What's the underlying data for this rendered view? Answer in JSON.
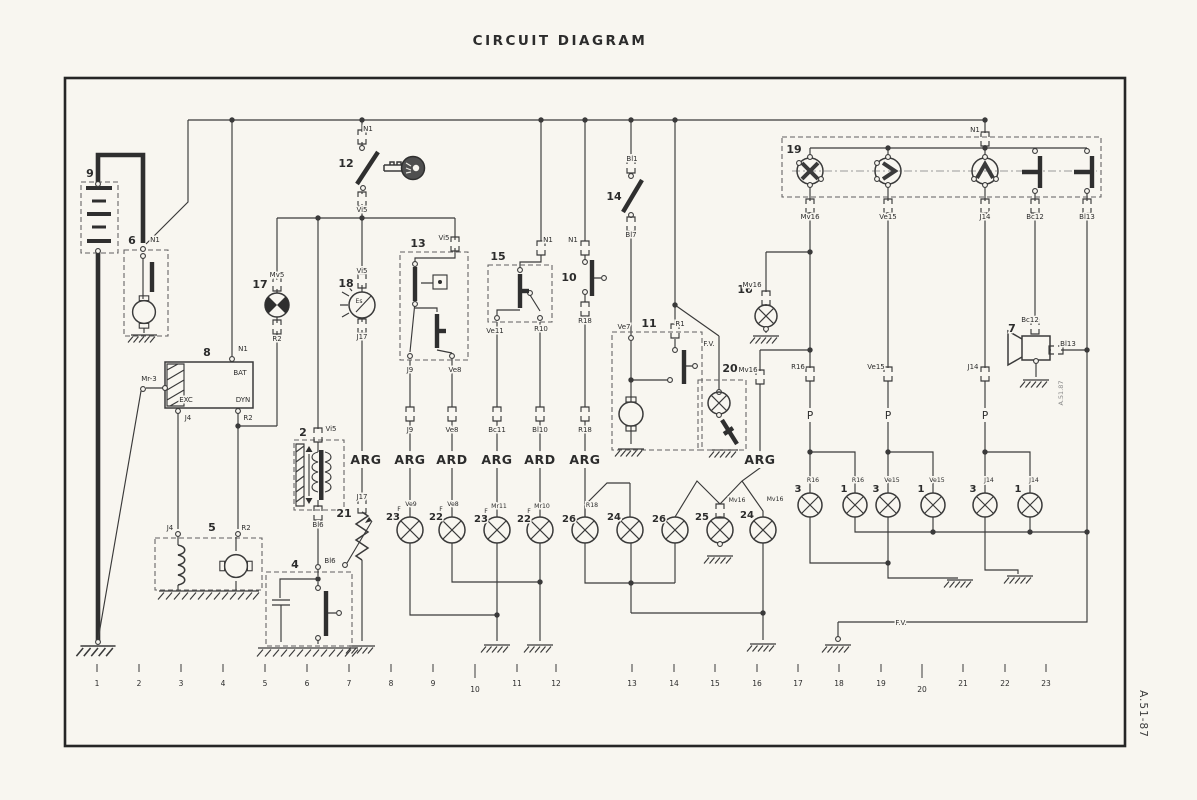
{
  "title": "CIRCUIT DIAGRAM",
  "refs": {
    "outer": "A.51-87",
    "inner": "A.51.87"
  },
  "codes": {
    "N1": "N1",
    "Vi5": "Vi5",
    "Mv5": "Mv5",
    "R2": "R2",
    "J17": "J17",
    "Es": "Es",
    "Bl1": "Bl1",
    "Bl7": "Bl7",
    "Bl6": "Bl6",
    "J4": "J4",
    "Mr3": "Mr-3",
    "BAT": "BAT",
    "EXC": "EXC",
    "DYN": "DYN",
    "J9": "J9",
    "Ve8": "Ve8",
    "F": "F",
    "Ve9": "Ve9",
    "Mr11": "Mr11",
    "Mr10": "Mr10",
    "Bc11": "Bc11",
    "Bl10": "Bl10",
    "Ve11": "Ve11",
    "R10": "R10",
    "R18": "R18",
    "Ve7": "Ve7",
    "R1": "R1",
    "FV": "F.V.",
    "Mv16": "Mv16",
    "Ve15": "Ve15",
    "J14": "J14",
    "Bc12": "Bc12",
    "Bl13": "Bl13",
    "R16": "R16",
    "P": "P",
    "ARG": "ARG",
    "ARD": "ARD"
  },
  "num": {
    "n1": "1",
    "n2": "2",
    "n3": "3",
    "n4": "4",
    "n5": "5",
    "n6": "6",
    "n7": "7",
    "n8": "8",
    "n9": "9",
    "n10": "10",
    "n11": "11",
    "n12": "12",
    "n13": "13",
    "n14": "14",
    "n15": "15",
    "n16": "16",
    "n17": "17",
    "n18": "18",
    "n19": "19",
    "n20": "20",
    "n21": "21",
    "n22": "22",
    "n23": "23",
    "n24": "24",
    "n25": "25",
    "n26": "26"
  },
  "scale": [
    "1",
    "2",
    "3",
    "4",
    "5",
    "6",
    "7",
    "8",
    "9",
    "10",
    "11",
    "12",
    "13",
    "14",
    "15",
    "16",
    "17",
    "18",
    "19",
    "20",
    "21",
    "22",
    "23"
  ]
}
